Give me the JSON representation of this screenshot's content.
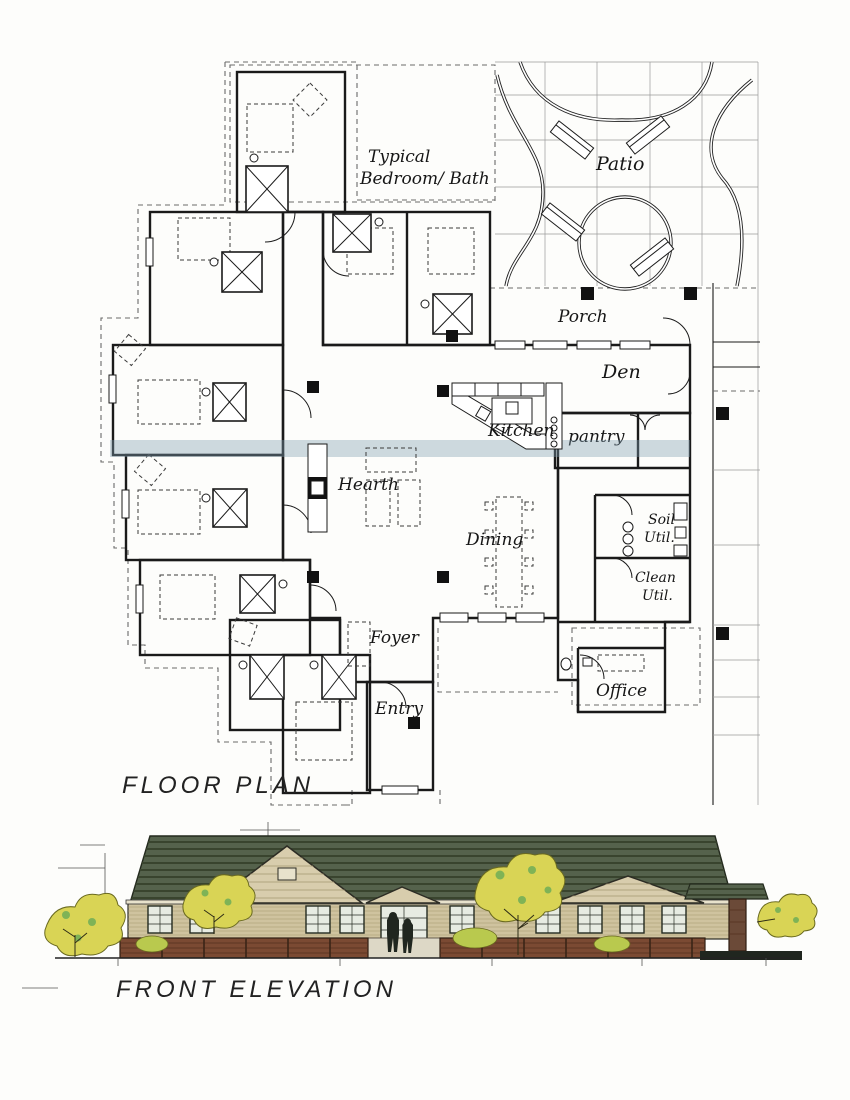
{
  "document": {
    "type": "architectural drawing",
    "sheet": "floor plan and front elevation"
  },
  "floor_plan": {
    "title": "FLOOR PLAN",
    "rooms": {
      "typical_line1": "Typical",
      "typical_line2": "Bedroom/ Bath",
      "patio": "Patio",
      "porch": "Porch",
      "den": "Den",
      "kitchen": "Kitchen",
      "pantry": "pantry",
      "hearth": "Hearth",
      "dining": "Dining",
      "soil_line1": "Soil",
      "soil_line2": "Util.",
      "clean_line1": "Clean",
      "clean_line2": "Util.",
      "foyer": "Foyer",
      "entry": "Entry",
      "office": "Office"
    },
    "colors": {
      "common_green": "#8BA98C",
      "bedroom_tan": "#D7CCBD",
      "service_yellow": "#EFE5A4",
      "sky_band_blue": "#7D9FAF",
      "wall_ink": "#1A1A1A"
    }
  },
  "elevation": {
    "title": "FRONT ELEVATION",
    "colors": {
      "roof_green": "#55624C",
      "siding_tan": "#CFC39F",
      "gable_tan": "#D8CDAD",
      "brick_brown": "#7B4A33",
      "foliage_yellow": "#D9D455",
      "foliage_green": "#7FB356",
      "figure_dark": "#20261F"
    }
  }
}
